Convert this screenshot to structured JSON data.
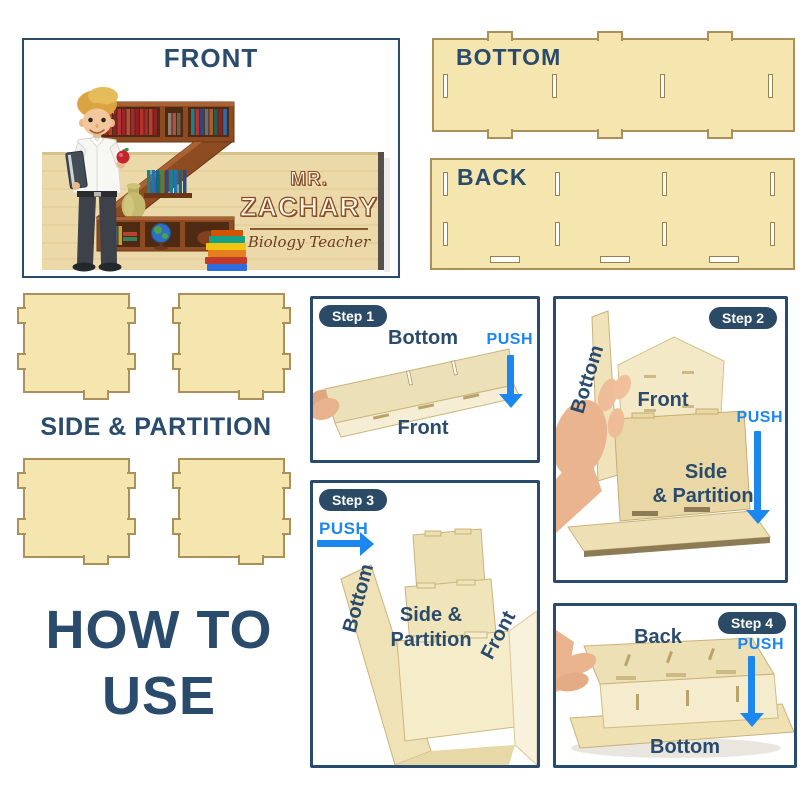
{
  "front_panel": {
    "title": "FRONT",
    "name_plate": {
      "prefix": "MR.",
      "name": "ZACHARY",
      "subtitle": "Biology Teacher",
      "monogram_letter": "Z"
    }
  },
  "parts": {
    "bottom": "BOTTOM",
    "back": "BACK",
    "side_partition": "SIDE & PARTITION"
  },
  "heading": {
    "line1": "HOW TO",
    "line2": "USE"
  },
  "steps": {
    "step1": {
      "badge": "Step 1",
      "top_label": "Bottom",
      "bottom_label": "Front",
      "push": "PUSH"
    },
    "step2": {
      "badge": "Step 2",
      "rotated_label": "Bottom",
      "front_label": "Front",
      "side_line1": "Side",
      "side_line2": "& Partition",
      "push": "PUSH"
    },
    "step3": {
      "badge": "Step 3",
      "rotated_label": "Bottom",
      "side_line1": "Side &",
      "side_line2": "Partition",
      "front_label": "Front",
      "push": "PUSH"
    },
    "step4": {
      "badge": "Step 4",
      "top_label": "Back",
      "bottom_label": "Bottom",
      "push": "PUSH"
    }
  },
  "colors": {
    "navy": "#2a4b6c",
    "push_blue": "#1d87f0",
    "wood_light": "#f5e5af",
    "wood_border": "#ab905a",
    "plate_wood": "#ecd9a9",
    "name_outline_brown": "#8a4a26"
  }
}
